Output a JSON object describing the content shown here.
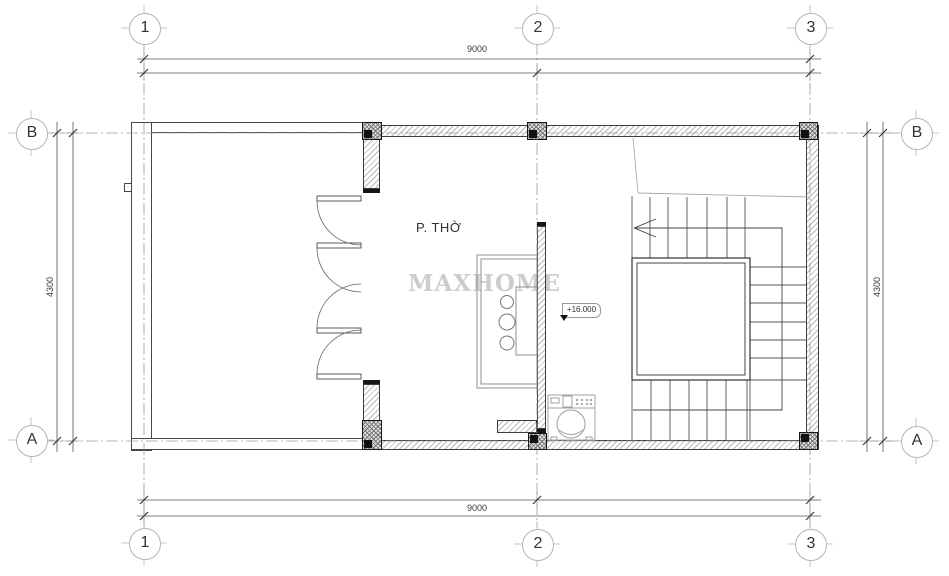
{
  "grid": {
    "columns": [
      {
        "label": "1"
      },
      {
        "label": "2"
      },
      {
        "label": "3"
      }
    ],
    "rows": [
      {
        "label": "B"
      },
      {
        "label": "A"
      }
    ]
  },
  "dimensions": {
    "top": "9000",
    "bottom": "9000",
    "left": "4300",
    "right": "4300"
  },
  "labels": {
    "room": "P. THỜ",
    "elevation": "+16.000",
    "watermark": "MAXHOME"
  },
  "symbols": {
    "staircase": "u-stair-around-void-with-walk-line-arrow",
    "doors": "quad-swing-door-leaves",
    "furniture": [
      "altar-table-with-incense-bowls",
      "washing-machine"
    ],
    "elevation_marker": "level-tag-with-triangle"
  },
  "colors": {
    "wall_line": "#3c3c3c",
    "hatch": "#b8b8b8",
    "column": "#6f6f6f",
    "cap": "#161616",
    "grid_line": "#9a9a9a",
    "dimension_line": "#555555",
    "text": "#333333",
    "watermark": "#cdcdcd"
  }
}
